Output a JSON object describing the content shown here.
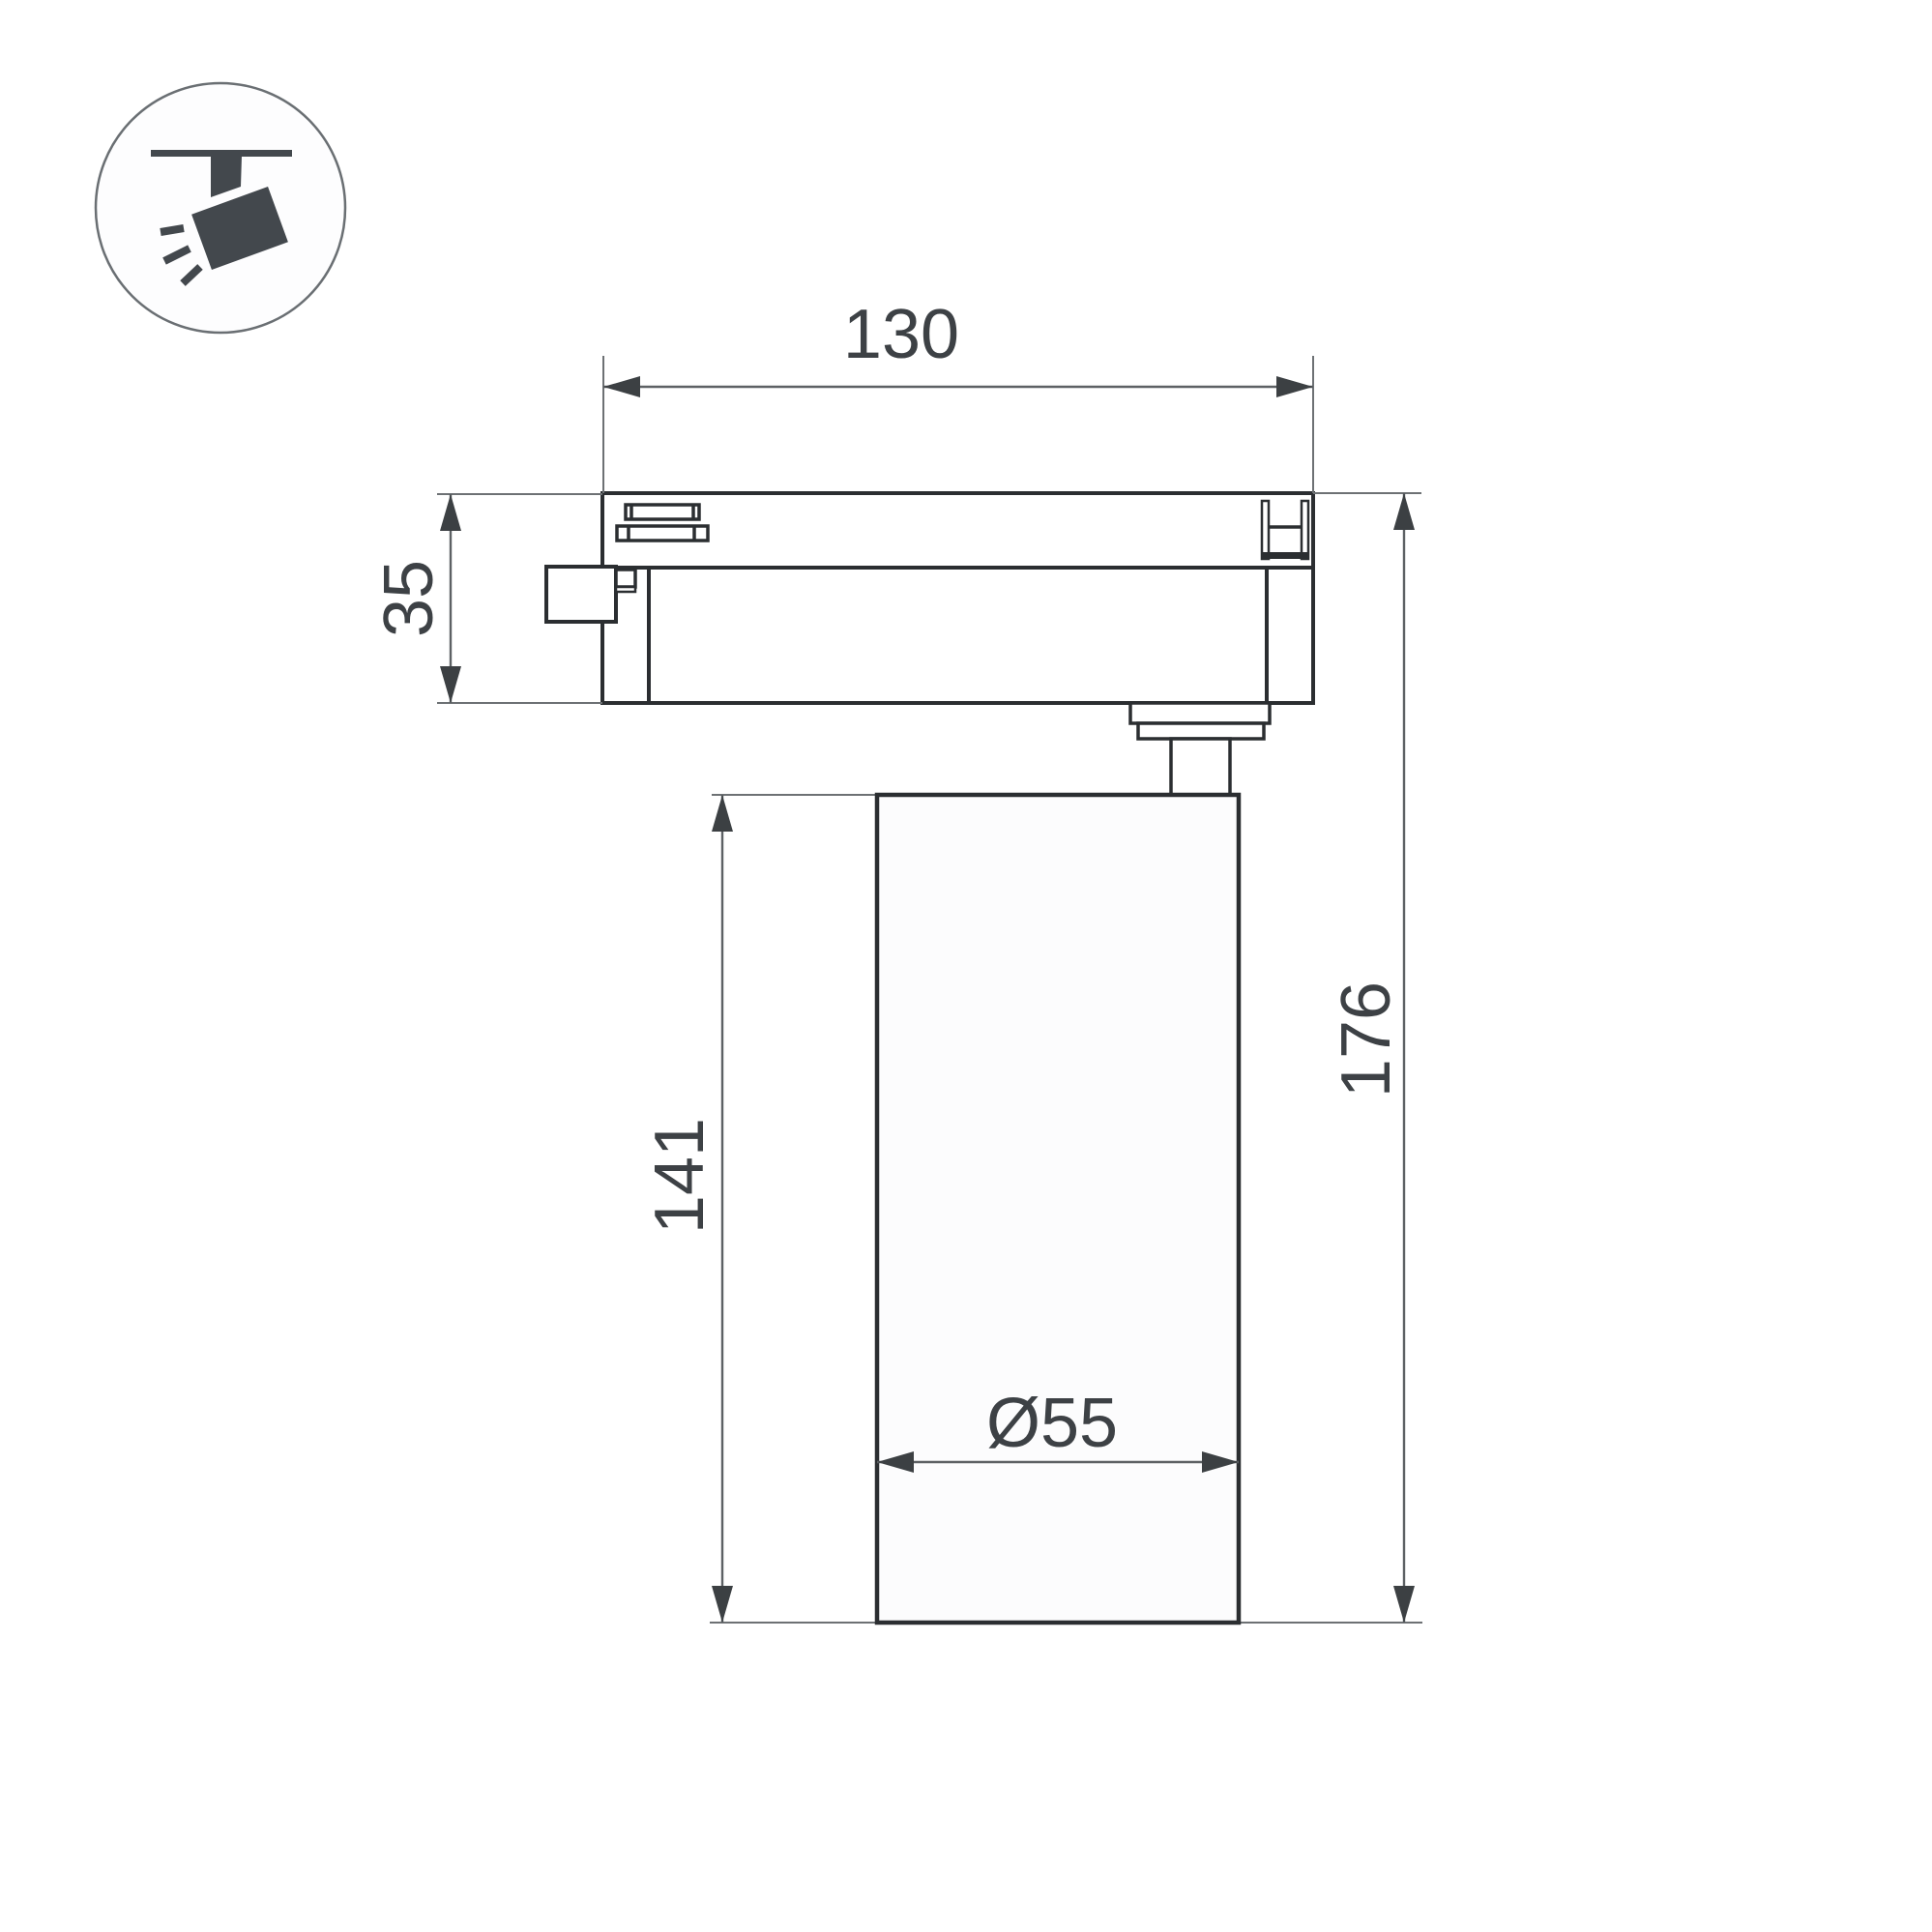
{
  "page": {
    "background": "#ffffff",
    "type": "technical-dimension-drawing",
    "subject": "LED track spotlight, side view with dimensions"
  },
  "legend_icon": {
    "name": "track-spotlight",
    "circle_stroke": "#6a6f73",
    "glyph_color": "#43484d"
  },
  "drawing": {
    "outline_color": "#2b2e31",
    "dimension_color": "#5d6164",
    "label_color": "#3d4145",
    "dimensions": {
      "track_adapter_width": "130",
      "track_adapter_height": "35",
      "lamp_body_height": "141",
      "overall_height": "176",
      "lamp_body_diameter": "Ø55"
    }
  }
}
